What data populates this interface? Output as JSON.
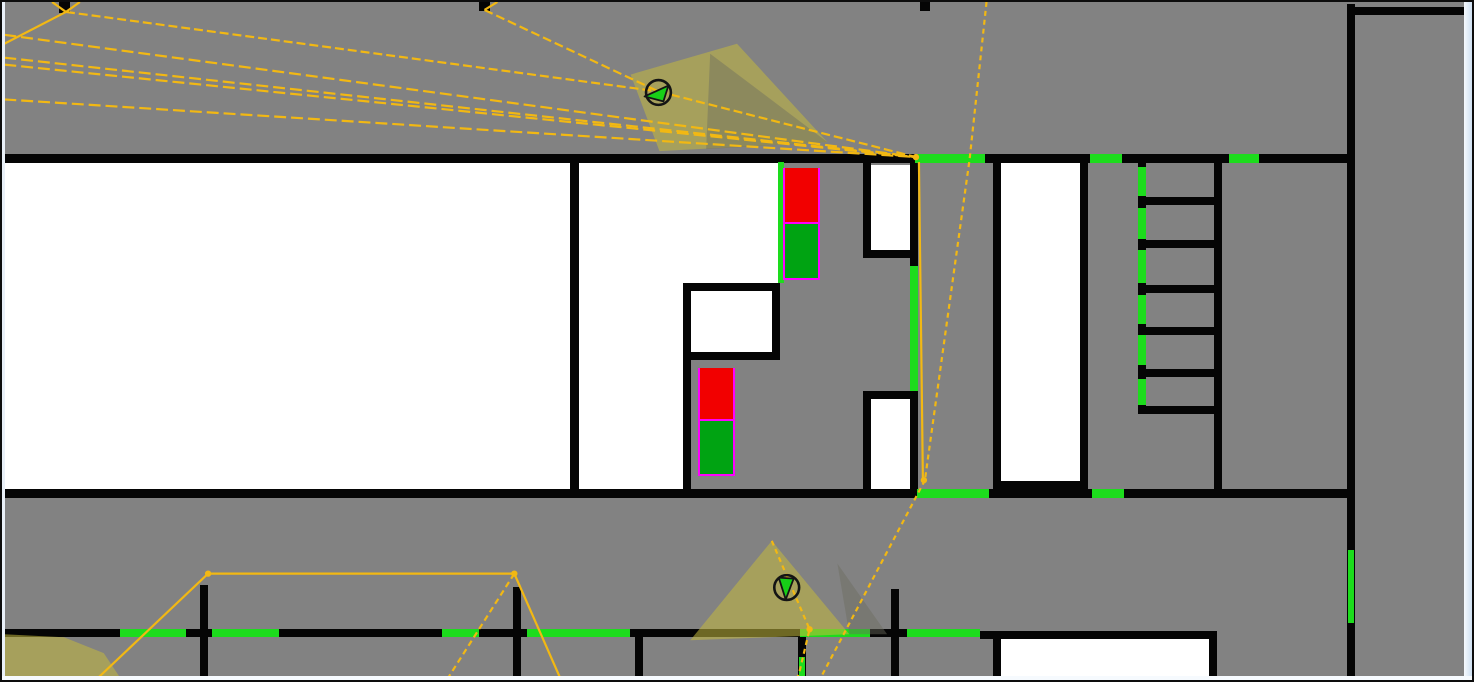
{
  "app": {
    "description": "floorplan simulation canvas with camera sensors, vision cones, path network, doors and exit markers",
    "visible_text": ""
  },
  "colors": {
    "background": "#828282",
    "wall": "#050505",
    "room_fill": "#ffffff",
    "door_green": "#1ddc1d",
    "marker_red": "#f20000",
    "marker_green": "#00a312",
    "marker_outline": "#ff00ff",
    "path_yellow": "#f2b813",
    "cone_fill": "rgba(197,185,62,0.55)",
    "cone_shadow": "rgba(108,108,96,0.45)",
    "border_light": "#f6fafe",
    "border_blue": "#cfe0f2"
  },
  "floorplan": {
    "canvas": {
      "width": 1474,
      "height": 682
    },
    "rooms": [
      {
        "x": 2,
        "y": 161,
        "w": 566,
        "h": 326
      },
      {
        "x": 577,
        "y": 161,
        "w": 200,
        "h": 120
      },
      {
        "x": 577,
        "y": 281,
        "w": 104,
        "h": 206
      },
      {
        "x": 688,
        "y": 289,
        "w": 82,
        "h": 61
      },
      {
        "x": 869,
        "y": 163,
        "w": 39,
        "h": 85
      },
      {
        "x": 869,
        "y": 397,
        "w": 39,
        "h": 91
      },
      {
        "x": 999,
        "y": 161,
        "w": 79,
        "h": 318
      },
      {
        "x": 998,
        "y": 637,
        "w": 209,
        "h": 45
      }
    ],
    "walls": [
      {
        "x": 0,
        "y": 152,
        "w": 1346,
        "h": 9
      },
      {
        "x": 0,
        "y": 487,
        "w": 1346,
        "h": 9
      },
      {
        "x": 568,
        "y": 152,
        "w": 9,
        "h": 344
      },
      {
        "x": 681,
        "y": 281,
        "w": 97,
        "h": 8
      },
      {
        "x": 681,
        "y": 281,
        "w": 8,
        "h": 215
      },
      {
        "x": 770,
        "y": 281,
        "w": 8,
        "h": 77
      },
      {
        "x": 681,
        "y": 350,
        "w": 97,
        "h": 8
      },
      {
        "x": 861,
        "y": 152,
        "w": 8,
        "h": 104
      },
      {
        "x": 861,
        "y": 248,
        "w": 55,
        "h": 8
      },
      {
        "x": 908,
        "y": 152,
        "w": 8,
        "h": 112
      },
      {
        "x": 908,
        "y": 389,
        "w": 8,
        "h": 107
      },
      {
        "x": 861,
        "y": 389,
        "w": 8,
        "h": 107
      },
      {
        "x": 861,
        "y": 389,
        "w": 55,
        "h": 8
      },
      {
        "x": 991,
        "y": 152,
        "w": 8,
        "h": 344
      },
      {
        "x": 1078,
        "y": 152,
        "w": 8,
        "h": 344
      },
      {
        "x": 991,
        "y": 479,
        "w": 95,
        "h": 9
      },
      {
        "x": 1136,
        "y": 152,
        "w": 8,
        "h": 260
      },
      {
        "x": 1136,
        "y": 195,
        "w": 84,
        "h": 8
      },
      {
        "x": 1136,
        "y": 238,
        "w": 84,
        "h": 8
      },
      {
        "x": 1136,
        "y": 283,
        "w": 84,
        "h": 8
      },
      {
        "x": 1136,
        "y": 325,
        "w": 84,
        "h": 8
      },
      {
        "x": 1136,
        "y": 367,
        "w": 84,
        "h": 8
      },
      {
        "x": 1136,
        "y": 404,
        "w": 84,
        "h": 8
      },
      {
        "x": 1212,
        "y": 152,
        "w": 8,
        "h": 344
      },
      {
        "x": 1345,
        "y": 2,
        "w": 8,
        "h": 680
      },
      {
        "x": 1353,
        "y": 5,
        "w": 109,
        "h": 8
      },
      {
        "x": 0,
        "y": 627,
        "w": 978,
        "h": 8
      },
      {
        "x": 978,
        "y": 629,
        "w": 237,
        "h": 8
      },
      {
        "x": 991,
        "y": 629,
        "w": 8,
        "h": 53
      },
      {
        "x": 1207,
        "y": 629,
        "w": 8,
        "h": 53
      },
      {
        "x": 198,
        "y": 583,
        "w": 8,
        "h": 99
      },
      {
        "x": 511,
        "y": 585,
        "w": 8,
        "h": 97
      },
      {
        "x": 633,
        "y": 627,
        "w": 8,
        "h": 55
      },
      {
        "x": 889,
        "y": 587,
        "w": 8,
        "h": 95
      },
      {
        "x": 796,
        "y": 635,
        "w": 8,
        "h": 47
      },
      {
        "x": 57,
        "y": 0,
        "w": 11,
        "h": 11
      },
      {
        "x": 477,
        "y": 0,
        "w": 11,
        "h": 9
      },
      {
        "x": 918,
        "y": 0,
        "w": 10,
        "h": 9
      }
    ],
    "doors": [
      {
        "x": 776,
        "y": 160,
        "w": 6,
        "h": 121
      },
      {
        "x": 913,
        "y": 152,
        "w": 70,
        "h": 9
      },
      {
        "x": 1088,
        "y": 152,
        "w": 32,
        "h": 9
      },
      {
        "x": 1227,
        "y": 152,
        "w": 30,
        "h": 9
      },
      {
        "x": 908,
        "y": 264,
        "w": 8,
        "h": 125
      },
      {
        "x": 1136,
        "y": 165,
        "w": 8,
        "h": 29
      },
      {
        "x": 1136,
        "y": 206,
        "w": 8,
        "h": 31
      },
      {
        "x": 1136,
        "y": 248,
        "w": 8,
        "h": 33
      },
      {
        "x": 1136,
        "y": 293,
        "w": 8,
        "h": 29
      },
      {
        "x": 1136,
        "y": 333,
        "w": 8,
        "h": 30
      },
      {
        "x": 1136,
        "y": 377,
        "w": 8,
        "h": 26
      },
      {
        "x": 915,
        "y": 487,
        "w": 72,
        "h": 9
      },
      {
        "x": 1090,
        "y": 487,
        "w": 32,
        "h": 9
      },
      {
        "x": 1346,
        "y": 548,
        "w": 6,
        "h": 73
      },
      {
        "x": 118,
        "y": 627,
        "w": 66,
        "h": 8
      },
      {
        "x": 210,
        "y": 627,
        "w": 67,
        "h": 8
      },
      {
        "x": 440,
        "y": 627,
        "w": 37,
        "h": 8
      },
      {
        "x": 525,
        "y": 627,
        "w": 103,
        "h": 8
      },
      {
        "x": 798,
        "y": 627,
        "w": 70,
        "h": 8
      },
      {
        "x": 905,
        "y": 627,
        "w": 73,
        "h": 8
      },
      {
        "x": 797,
        "y": 655,
        "w": 6,
        "h": 20
      }
    ],
    "markers": [
      {
        "x": 783,
        "y": 166,
        "w": 33,
        "red_h": 54,
        "sep": 2,
        "green_h": 54
      },
      {
        "x": 698,
        "y": 366,
        "w": 33,
        "red_h": 51,
        "sep": 2,
        "green_h": 53
      }
    ],
    "cones": [
      {
        "points": [
          [
            630,
            73
          ],
          [
            737,
            42
          ],
          [
            828,
            141
          ],
          [
            659,
            150
          ]
        ],
        "kind": "vision"
      },
      {
        "points": [
          [
            710,
            52
          ],
          [
            828,
            141
          ],
          [
            706,
            148
          ]
        ],
        "kind": "shadow"
      },
      {
        "points": [
          [
            772,
            542
          ],
          [
            690,
            642
          ],
          [
            850,
            636
          ]
        ],
        "kind": "vision"
      },
      {
        "points": [
          [
            838,
            565
          ],
          [
            888,
            636
          ],
          [
            850,
            636
          ]
        ],
        "kind": "shadow"
      },
      {
        "points": [
          [
            0,
            636
          ],
          [
            60,
            639
          ],
          [
            100,
            655
          ],
          [
            118,
            682
          ],
          [
            0,
            682
          ]
        ],
        "kind": "vision"
      }
    ],
    "paths": [
      {
        "points": [
          [
            0,
            42
          ],
          [
            62,
            10
          ]
        ],
        "dash": ""
      },
      {
        "points": [
          [
            48,
            0
          ],
          [
            62,
            10
          ]
        ],
        "dash": ""
      },
      {
        "points": [
          [
            62,
            10
          ],
          [
            76,
            0
          ]
        ],
        "dash": ""
      },
      {
        "points": [
          [
            483,
            8
          ],
          [
            496,
            0
          ]
        ],
        "dash": ""
      },
      {
        "points": [
          [
            62,
            10
          ],
          [
            658,
            90
          ]
        ],
        "dash": "9 4"
      },
      {
        "points": [
          [
            483,
            8
          ],
          [
            658,
            90
          ]
        ],
        "dash": "9 4"
      },
      {
        "points": [
          [
            0,
            33
          ],
          [
            917,
            156
          ]
        ],
        "dash": "12 5"
      },
      {
        "points": [
          [
            0,
            56
          ],
          [
            917,
            156
          ]
        ],
        "dash": "12 5"
      },
      {
        "points": [
          [
            0,
            63
          ],
          [
            917,
            156
          ]
        ],
        "dash": "12 5"
      },
      {
        "points": [
          [
            0,
            98
          ],
          [
            917,
            156
          ]
        ],
        "dash": "12 5"
      },
      {
        "points": [
          [
            658,
            90
          ],
          [
            917,
            156
          ]
        ],
        "dash": "9 4"
      },
      {
        "points": [
          [
            988,
            0
          ],
          [
            971,
            158
          ],
          [
            926,
            481
          ]
        ],
        "dash": "5 4"
      },
      {
        "points": [
          [
            920,
            161
          ],
          [
            924,
            481
          ]
        ],
        "dash": ""
      },
      {
        "points": [
          [
            926,
            481
          ],
          [
            820,
            682
          ]
        ],
        "dash": "5 4"
      },
      {
        "points": [
          [
            772,
            542
          ],
          [
            810,
            631
          ],
          [
            800,
            673
          ],
          [
            797,
            682
          ]
        ],
        "dash": "5 4"
      },
      {
        "points": [
          [
            92,
            682
          ],
          [
            205,
            575
          ],
          [
            513,
            575
          ],
          [
            560,
            682
          ]
        ],
        "dash": ""
      },
      {
        "points": [
          [
            513,
            575
          ],
          [
            445,
            682
          ]
        ],
        "dash": "6 4"
      }
    ],
    "dots": [
      {
        "x": 917,
        "y": 156
      },
      {
        "x": 925,
        "y": 481
      },
      {
        "x": 810,
        "y": 631
      },
      {
        "x": 205,
        "y": 575
      },
      {
        "x": 513,
        "y": 575
      }
    ],
    "sensors": [
      {
        "cx": 658,
        "cy": 91,
        "r": 12.5,
        "arrow": [
          [
            644,
            95
          ],
          [
            668,
            84
          ],
          [
            663,
            100
          ]
        ]
      },
      {
        "cx": 787,
        "cy": 589,
        "r": 12.5,
        "arrow": [
          [
            779,
            579
          ],
          [
            794,
            580
          ],
          [
            786,
            601
          ]
        ]
      }
    ]
  }
}
